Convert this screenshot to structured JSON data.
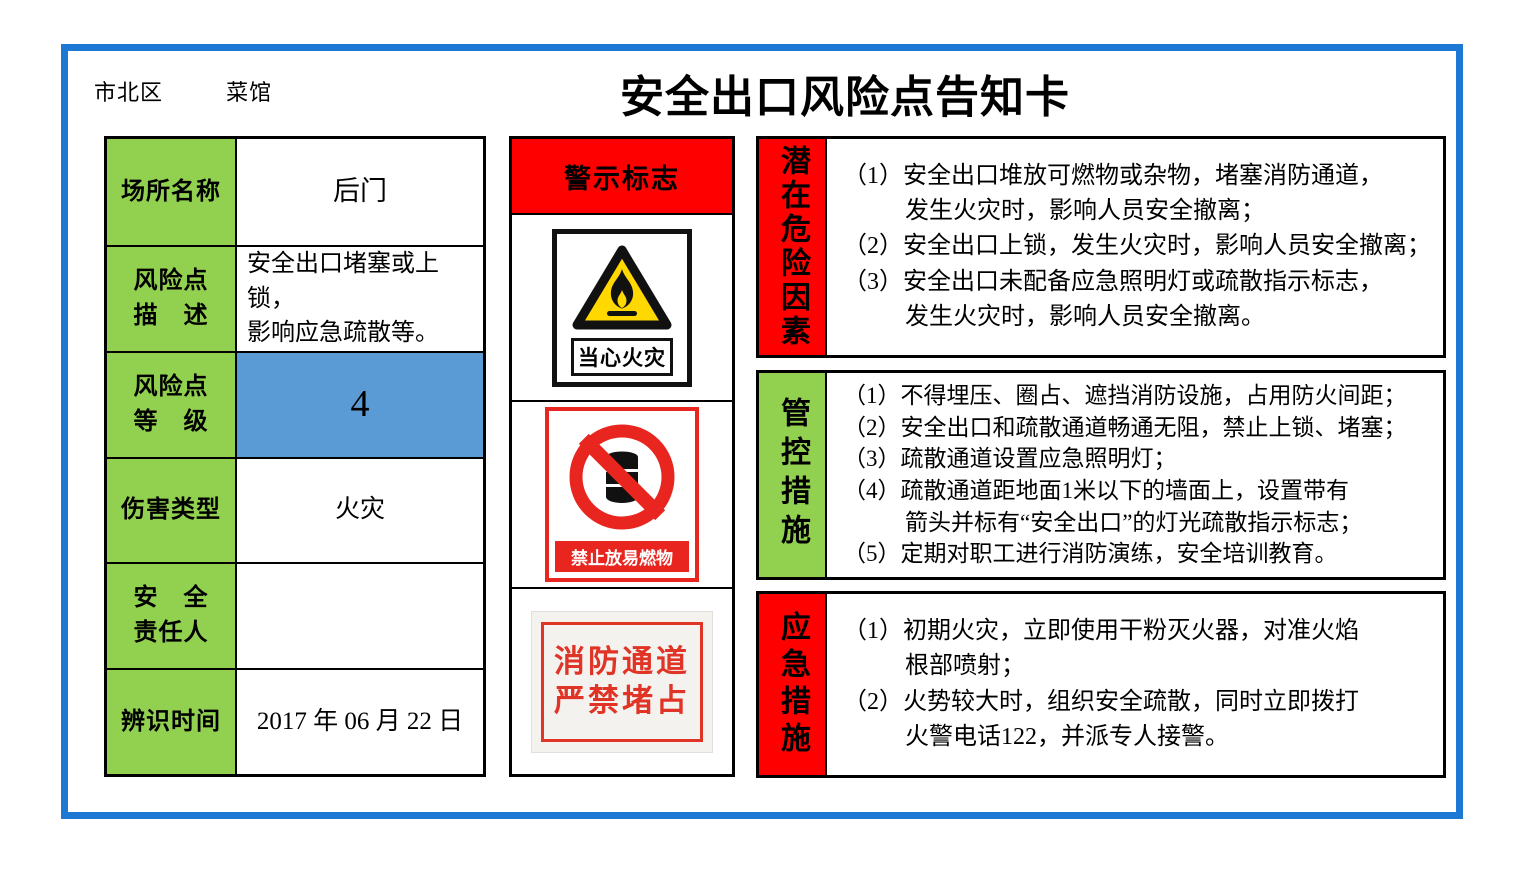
{
  "colors": {
    "card_border_blue": "#1c78d3",
    "label_green": "#92d050",
    "risk_level_blue": "#5b9bd5",
    "alert_red": "#fe0000",
    "sign_red": "#e8261f",
    "warning_yellow": "#ffd800"
  },
  "header": {
    "district": "市北区",
    "venue": "菜馆",
    "title": "安全出口风险点告知卡"
  },
  "info_table": {
    "rows": [
      {
        "label_lines": [
          "场所名称"
        ],
        "value_lines": [
          "后门"
        ]
      },
      {
        "label_lines": [
          "风险点",
          "描　述"
        ],
        "value_lines": [
          "安全出口堵塞或上锁，",
          "影响应急疏散等。"
        ]
      },
      {
        "label_lines": [
          "风险点",
          "等　级"
        ],
        "value_lines": [
          "4"
        ]
      },
      {
        "label_lines": [
          "伤害类型"
        ],
        "value_lines": [
          "火灾"
        ]
      },
      {
        "label_lines": [
          "安　全",
          "责任人"
        ],
        "value_lines": [
          ""
        ]
      },
      {
        "label_lines": [
          "辨识时间"
        ],
        "value_lines": [
          "2017 年 06 月 22 日"
        ]
      }
    ]
  },
  "signs": {
    "header": "警示标志",
    "fire_warning": {
      "label": "当心火灾"
    },
    "no_flammables": {
      "label": "禁止放易燃物"
    },
    "fire_lane": {
      "lines": [
        "消防通道",
        "严禁堵占"
      ]
    }
  },
  "sections": [
    {
      "label": "潜在危险因素",
      "lines": [
        "（1）安全出口堆放可燃物或杂物，堵塞消防通道，",
        "发生火灾时，影响人员安全撤离；",
        "（2）安全出口上锁，发生火灾时，影响人员安全撤离；",
        "（3）安全出口未配备应急照明灯或疏散指示标志，",
        "发生火灾时，影响人员安全撤离。"
      ]
    },
    {
      "label": "管控措施",
      "lines": [
        "（1）不得埋压、圈占、遮挡消防设施，占用防火间距；",
        "（2）安全出口和疏散通道畅通无阻，禁止上锁、堵塞；",
        "（3）疏散通道设置应急照明灯；",
        "（4）疏散通道距地面1米以下的墙面上，设置带有",
        "箭头并标有“安全出口”的灯光疏散指示标志；",
        "（5）定期对职工进行消防演练，安全培训教育。"
      ]
    },
    {
      "label": "应急措施",
      "lines": [
        "（1）初期火灾，立即使用干粉灭火器，对准火焰",
        "根部喷射；",
        "（2）火势较大时，组织安全疏散，同时立即拨打",
        "火警电话122，并派专人接警。"
      ]
    }
  ]
}
